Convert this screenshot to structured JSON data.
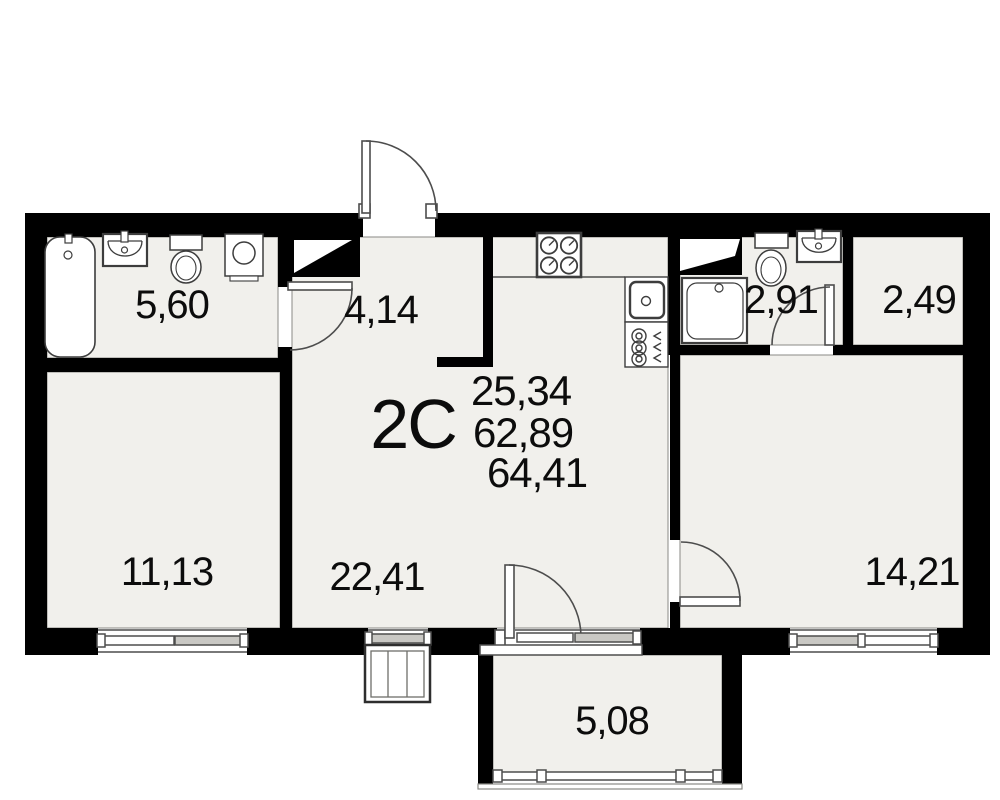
{
  "plan": {
    "type_label": "2С",
    "areas": {
      "living": "25,34",
      "usable": "62,89",
      "total": "64,41"
    },
    "rooms": [
      {
        "name": "bathroom",
        "label": "5,60"
      },
      {
        "name": "hallway",
        "label": "4,14"
      },
      {
        "name": "wc",
        "label": "2,91"
      },
      {
        "name": "storage",
        "label": "2,49"
      },
      {
        "name": "bedroom-left",
        "label": "11,13"
      },
      {
        "name": "living-kitchen",
        "label": "22,41"
      },
      {
        "name": "bedroom-right",
        "label": "14,21"
      },
      {
        "name": "balcony",
        "label": "5,08"
      }
    ],
    "fixtures": [
      "bathtub-icon",
      "bath-sink-icon",
      "toilet-icon",
      "washing-machine-icon",
      "stove-icon",
      "kitchen-sink-icon",
      "riser-icon",
      "shower-icon",
      "wc-toilet-icon",
      "wc-sink-icon",
      "vent-shaft-icon"
    ],
    "colors": {
      "wall": "#000000",
      "floor": "#f1f0ec",
      "outline": "#4d4d4d",
      "background": "#ffffff"
    }
  }
}
